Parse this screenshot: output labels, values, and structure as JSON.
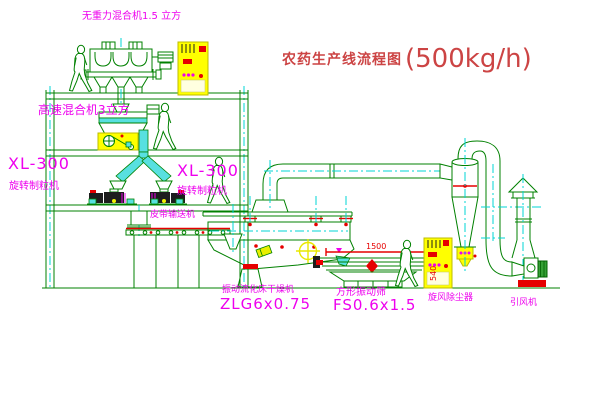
{
  "title": {
    "name": "农药生产线流程图",
    "capacity": "(500kg/h)"
  },
  "labels": {
    "gravity_mixer": "无重力混合机1.5 立方",
    "high_speed_mixer": "高速混合机3立方",
    "granulator_left": {
      "model": "XL-300",
      "name": "旋转制粒机"
    },
    "granulator_right": {
      "model": "XL-300",
      "name": "旋转制粒机"
    },
    "belt_conveyor": "皮带输送机",
    "dryer": {
      "name": "振动流化床干燥机",
      "model": "ZLG6x0.75"
    },
    "sieve": {
      "name": "方形振动筛",
      "model": "FS0.6x1.5"
    },
    "cyclone": "旋风除尘器",
    "fan": "引风机"
  },
  "dimensions": {
    "sieve_length": "1500",
    "sieve_height": "540"
  },
  "colors": {
    "line_green": "#008000",
    "centerline_cyan": "#00d5d5",
    "label_magenta": "#ee00ee",
    "detail_red": "#e60000",
    "cabinet_yellow": "#ffff00",
    "title_red": "#cc4444"
  }
}
